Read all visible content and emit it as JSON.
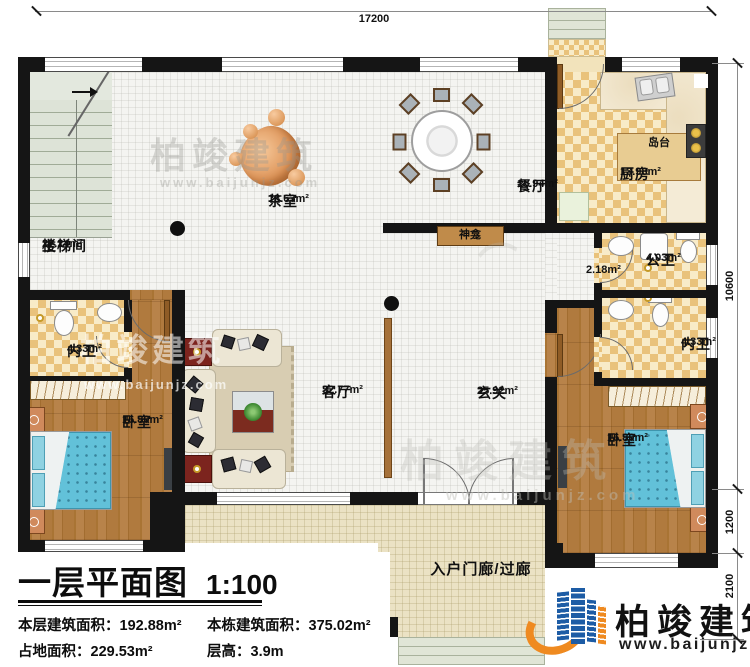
{
  "dimensions": {
    "top_width": "17200",
    "right_main": "10600",
    "right_ext1": "1200",
    "right_ext2": "2100"
  },
  "rooms": {
    "stair_up": "上",
    "stair_name": "楼梯间",
    "stair_area": "22.24m²",
    "tea_name": "茶室",
    "tea_area": "18.63m²",
    "dining_name": "餐厅",
    "dining_area": "15.94m²",
    "kitchen_name": "厨房",
    "kitchen_area": "13.98m²",
    "island_name": "岛台",
    "shrine_name": "神龛",
    "passage_area": "2.18m²",
    "pubbath_name": "公卫",
    "pubbath_area": "4.03m²",
    "bath_left_name": "内卫",
    "bath_left_area": "4.33m²",
    "bath_right_name": "内卫",
    "bath_right_area": "4.33m²",
    "bed_left_name": "卧室",
    "bed_left_area": "16.80m²",
    "bed_right_name": "卧室",
    "bed_right_area": "16.80m²",
    "living_name": "客厅",
    "living_area": "32.77m²",
    "foyer_name": "玄关",
    "foyer_area": "25.92m²",
    "porch_name": "入户门廊/过廊"
  },
  "title_block": {
    "title": "一层平面图",
    "scale": "1:100",
    "stats": [
      {
        "label": "本层建筑面积：",
        "value": "192.88m²"
      },
      {
        "label": "本栋建筑面积：",
        "value": "375.02m²"
      },
      {
        "label": "占地面积：",
        "value": "229.53m²"
      },
      {
        "label": "层高：",
        "value": "3.9m"
      }
    ]
  },
  "branding": {
    "logo_text": "柏竣建筑",
    "website": "www.baijunjz.com"
  }
}
